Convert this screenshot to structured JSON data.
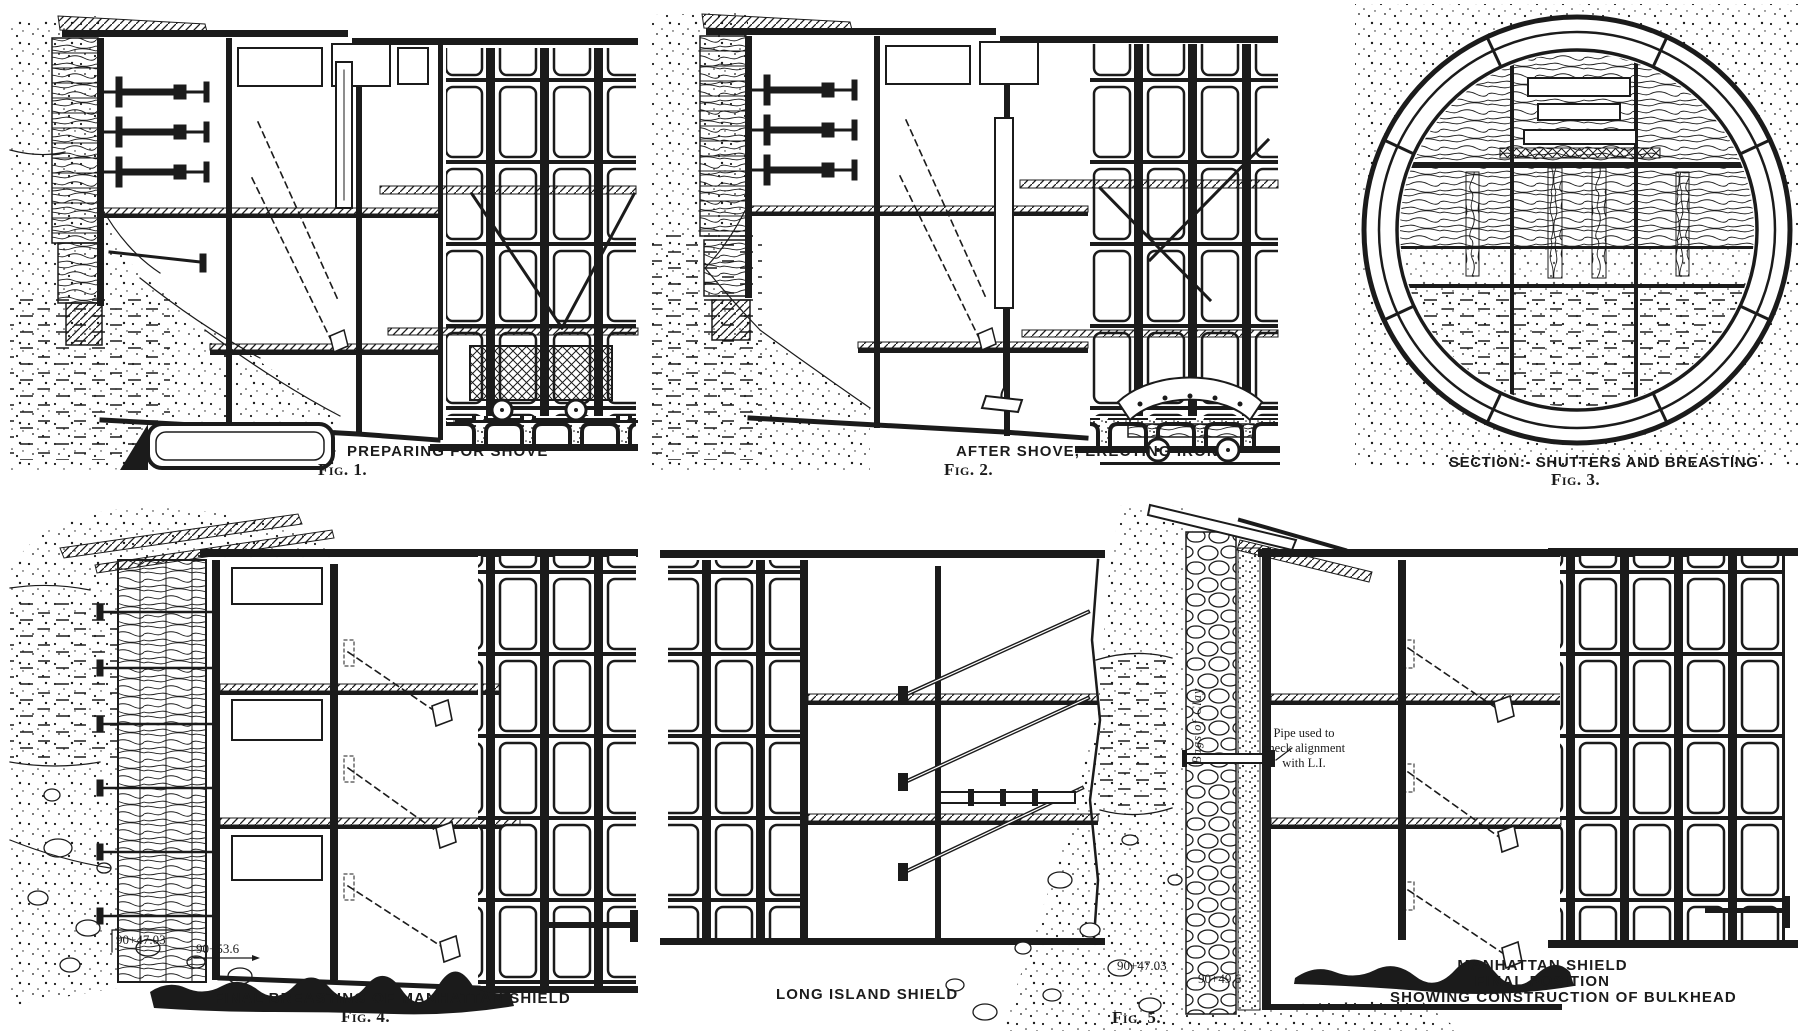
{
  "palette": {
    "ink": "#1b1b1b",
    "paper": "#ffffff"
  },
  "figures": {
    "fig1": {
      "caption": "PREPARING FOR SHOVE",
      "label": "Fig. 1."
    },
    "fig2": {
      "caption": "AFTER SHOVE, ERECTING IRON",
      "label": "Fig. 2."
    },
    "fig3": {
      "caption": "SECTION:- SHUTTERS AND BREASTING",
      "label": "Fig. 3."
    },
    "fig4": {
      "caption": "FINAL BREASTING OF MANHATTAN SHIELD",
      "label": "Fig. 4.",
      "station_left": "90+47.03",
      "station_right": "90+53.6"
    },
    "fig5": {
      "caption_long_island": "LONG ISLAND SHIELD",
      "label": "Fig. 5.",
      "caption_manhattan_line1": "MANHATTAN SHIELD",
      "caption_manhattan_line2": "FINAL POSITION",
      "caption_manhattan_line3": "SHOWING CONSTRUCTION OF BULKHEAD",
      "station_left": "90+47.03",
      "station_right": "90+49.6",
      "pipe_note_line1": "Pipe used to",
      "pipe_note_line2": "check alignment",
      "pipe_note_line3": "with L.I.",
      "bags_label": "Bags of Clay"
    }
  }
}
